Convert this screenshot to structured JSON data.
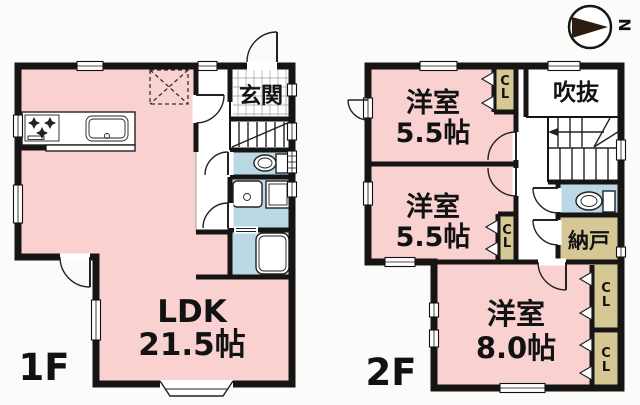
{
  "colors": {
    "room_pink": "#f8d1d0",
    "wet_blue": "#bad8e6",
    "closet_tan": "#d6c895",
    "wall": "#171513",
    "bg": "#fbfbf9",
    "text": "#121212"
  },
  "compass": {
    "north_label": "N"
  },
  "floor1": {
    "label": "1F",
    "rooms": {
      "entrance": "玄関",
      "ldk_name": "LDK",
      "ldk_size": "21.5帖"
    }
  },
  "floor2": {
    "label": "2F",
    "rooms": {
      "room_top_name": "洋室",
      "room_top_size": "5.5帖",
      "room_mid_name": "洋室",
      "room_mid_size": "5.5帖",
      "room_big_name": "洋室",
      "room_big_size": "8.0帖",
      "void": "吹抜",
      "storage": "納戸",
      "closet": "CL"
    }
  }
}
